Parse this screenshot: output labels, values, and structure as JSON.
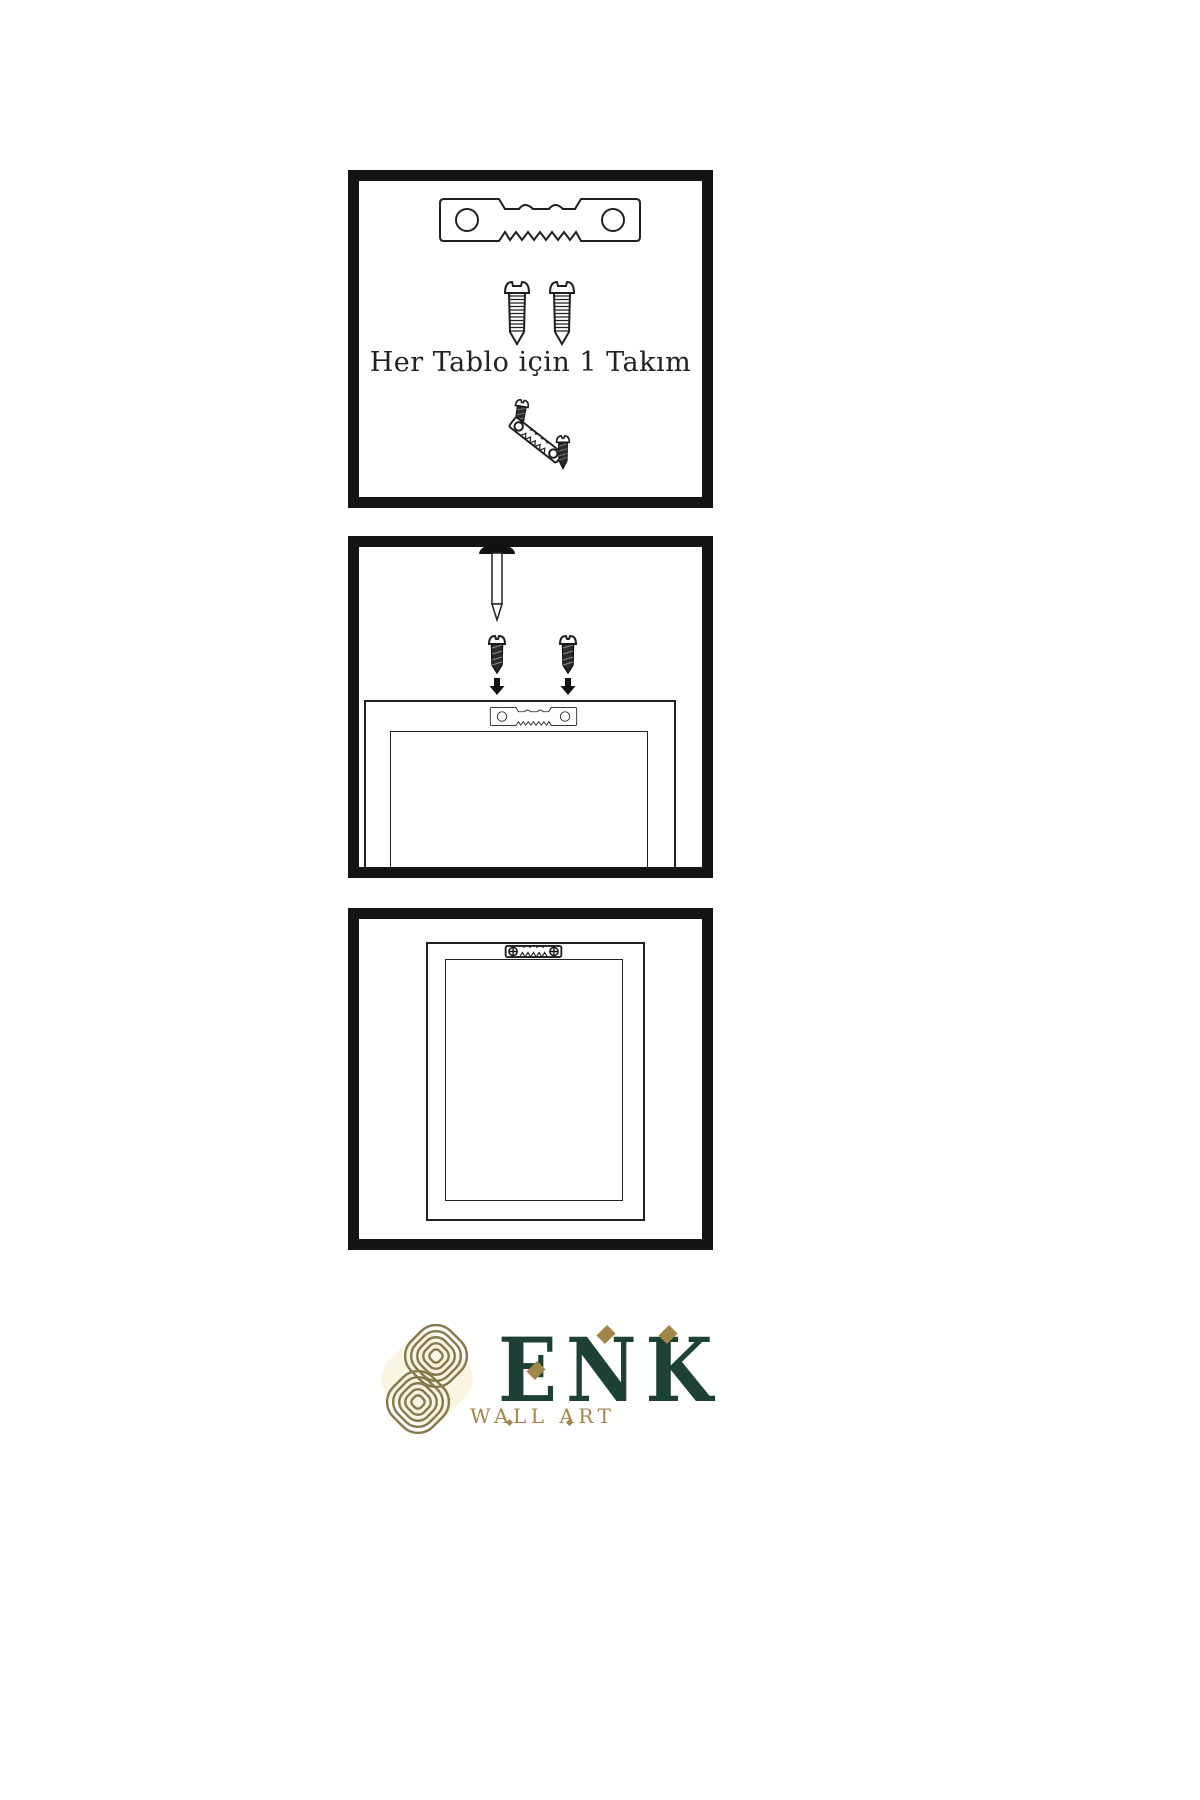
{
  "panels": {
    "panel1": {
      "caption": "Her Tablo için 1 Takım",
      "icons": [
        "sawtooth-hanger",
        "screw",
        "screw",
        "dark-screw",
        "tilted-sawtooth-hanger",
        "dark-screw"
      ]
    },
    "panel2": {
      "icons": [
        "wall-nail",
        "dark-screw-with-arrow",
        "dark-screw-with-arrow",
        "sawtooth-hanger-on-frame",
        "picture-frame-back"
      ]
    },
    "panel3": {
      "icons": [
        "mounted-sawtooth-hanger",
        "hanging-picture-frame"
      ]
    }
  },
  "brand": {
    "name": "ENK",
    "tagline": "WALL ART",
    "colors": {
      "green": "#1d4233",
      "gold": "#a08648",
      "knot": "#85794b",
      "knot_fill": "#faf5e3"
    }
  },
  "diagram": {
    "line_color": "#1f1f1f",
    "panel_border": "#141414"
  }
}
